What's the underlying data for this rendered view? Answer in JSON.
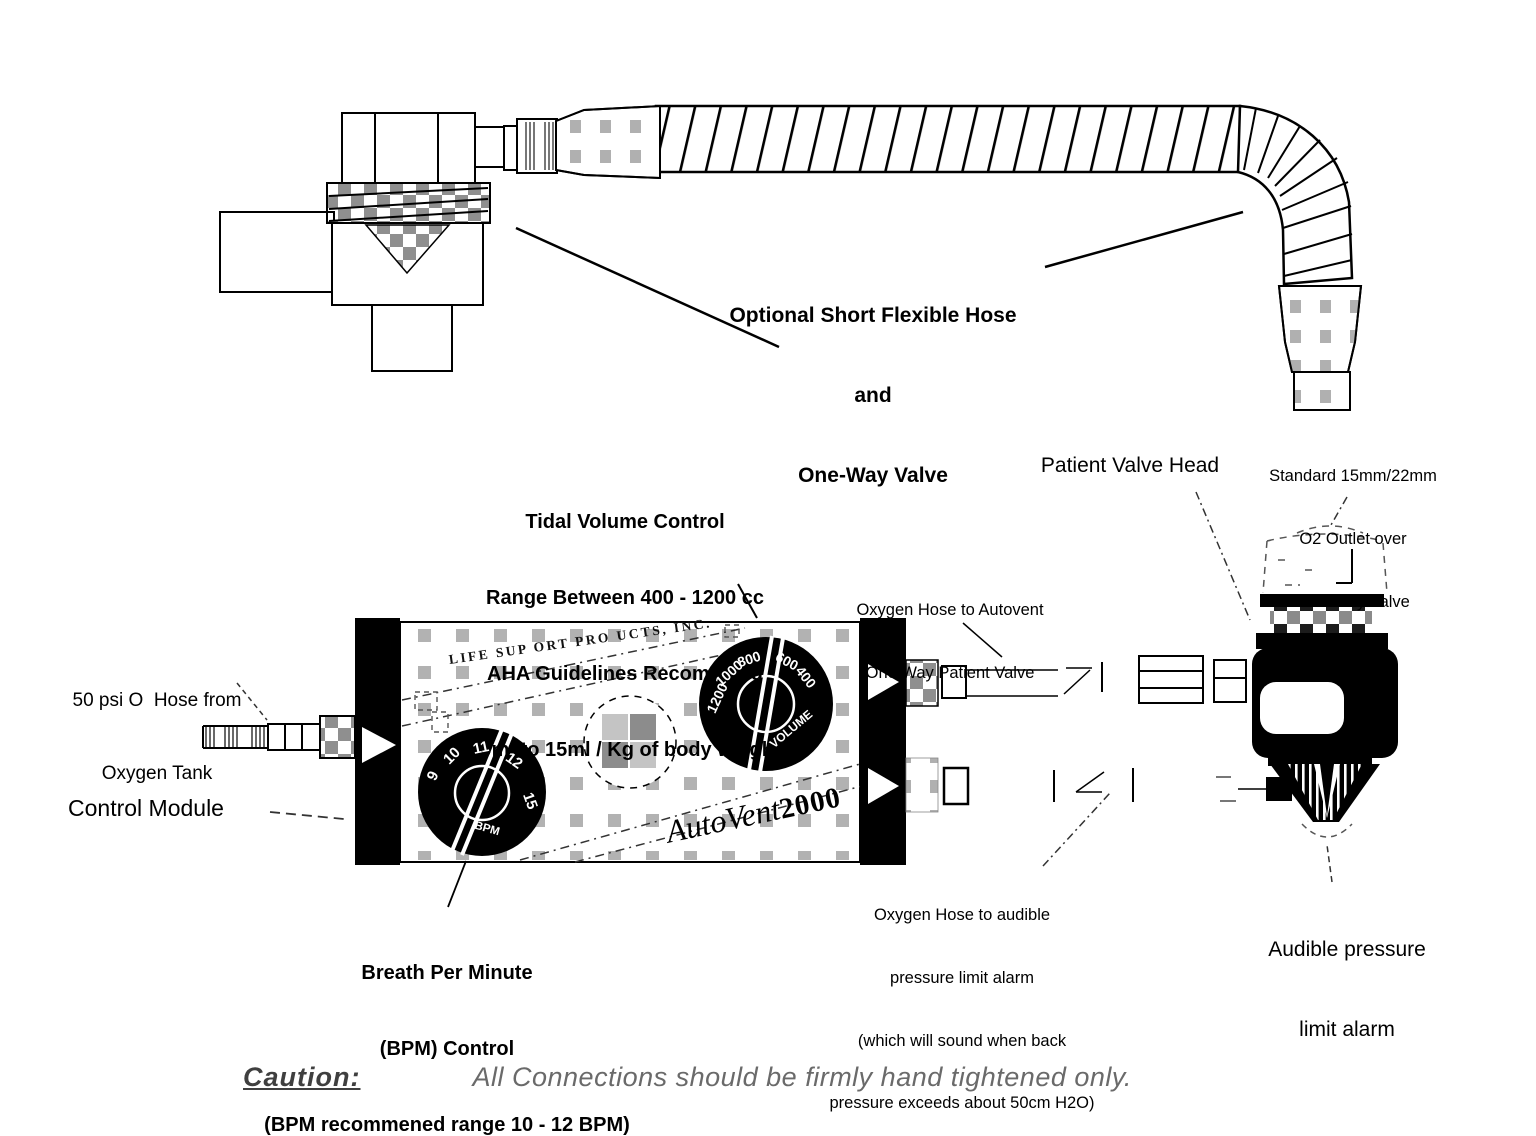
{
  "labels": {
    "optional_hose": {
      "line1": "Optional Short Flexible Hose",
      "line2": "and",
      "line3": "One-Way Valve"
    },
    "tidal": {
      "line1": "Tidal Volume Control",
      "line2": "Range Between 400 - 1200 cc",
      "line3": "AHA Guidelines Recommend",
      "line4": "10ml to 15ml / Kg of body weight"
    },
    "patient_valve_head": "Patient Valve Head",
    "standard_outlet": {
      "line1": "Standard 15mm/22mm",
      "line2": "O2 Outlet over",
      "line3": "One-Way Valve"
    },
    "oxygen_hose_patient": {
      "line1": "Oxygen Hose to Autovent",
      "line2": "One Way Patient Valve"
    },
    "psi_hose": {
      "line1": "50 psi O  Hose from",
      "line2": "Oxygen Tank"
    },
    "control_module": "Control Module",
    "bpm_control": {
      "line1": "Breath Per Minute",
      "line2": "(BPM) Control",
      "line3": "(BPM recommened range 10 - 12 BPM)"
    },
    "oxygen_hose_alarm": {
      "line1": "Oxygen Hose to audible",
      "line2": "pressure limit alarm",
      "line3": "(which will sound when back",
      "line4": "pressure exceeds about 50cm H2O)"
    },
    "audible_alarm": {
      "line1": "Audible pressure",
      "line2": "limit alarm"
    },
    "caution": {
      "heading": "Caution:",
      "text": "All Connections should be firmly hand tightened only."
    }
  },
  "module": {
    "manufacturer": "LIFE SUP ORT PRO UCTS, INC.",
    "brand_italic": "AutoVent",
    "brand_bold": "2000",
    "bpm_dial": {
      "labels": [
        "9",
        "10",
        "11",
        "12",
        "15"
      ],
      "caption": "BPM"
    },
    "volume_dial": {
      "labels": [
        "1200",
        "1000",
        "800",
        "600",
        "400"
      ],
      "caption": "VOLUME"
    }
  },
  "colors": {
    "ink": "#000000",
    "pattern_gray": "#ababab",
    "caution_gray": "#6a6a6a"
  }
}
